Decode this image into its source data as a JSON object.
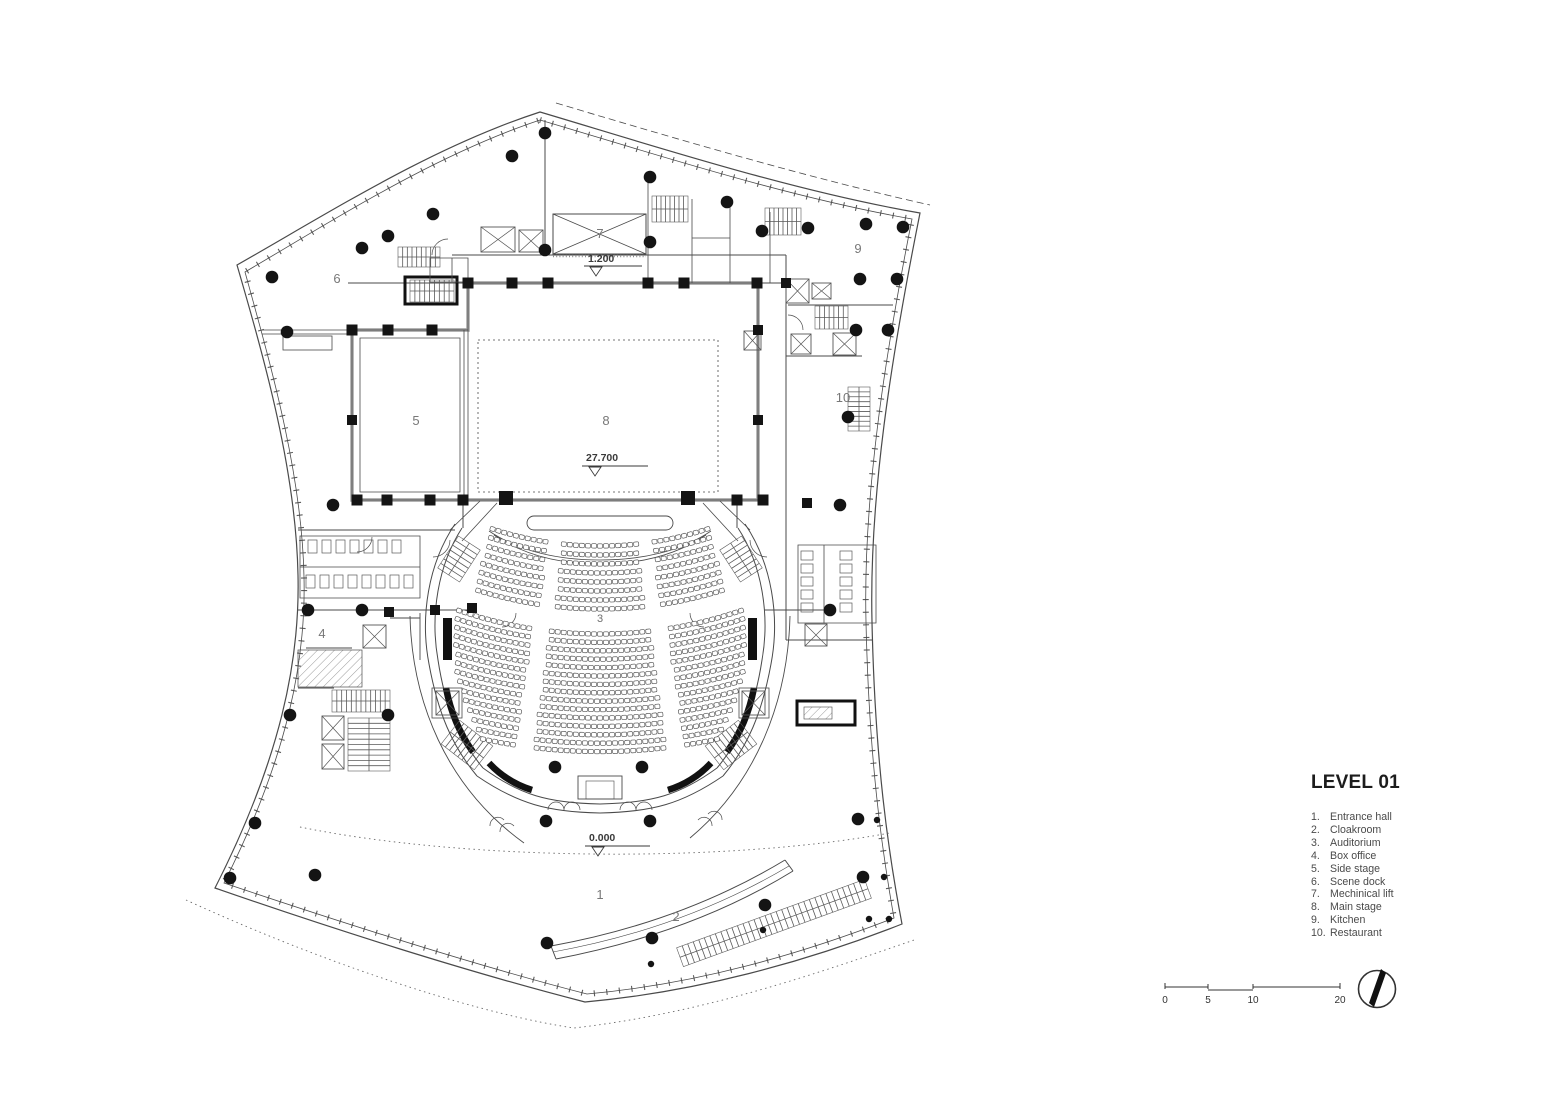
{
  "title": "LEVEL 01",
  "legend": {
    "items": [
      {
        "num": "1.",
        "name": "Entrance hall"
      },
      {
        "num": "2.",
        "name": "Cloakroom"
      },
      {
        "num": "3.",
        "name": "Auditorium"
      },
      {
        "num": "4.",
        "name": "Box office"
      },
      {
        "num": "5.",
        "name": "Side stage"
      },
      {
        "num": "6.",
        "name": "Scene dock"
      },
      {
        "num": "7.",
        "name": "Mechinical lift"
      },
      {
        "num": "8.",
        "name": "Main stage"
      },
      {
        "num": "9.",
        "name": "Kitchen"
      },
      {
        "num": "10.",
        "name": "Restaurant"
      }
    ]
  },
  "plan_labels": {
    "room1": "1",
    "room2": "2",
    "room3": "3",
    "room4": "4",
    "room5": "5",
    "room6": "6",
    "room7": "7",
    "room8": "8",
    "room9": "9",
    "room10": "10"
  },
  "elevations": {
    "stage_corridor": "1.200",
    "main_stage": "27.700",
    "entrance": "0.000"
  },
  "scale_bar": {
    "ticks": [
      "0",
      "5",
      "10",
      "20"
    ]
  },
  "colors": {
    "line": "#4a4a4a",
    "wall_gray": "#9c9c9c",
    "black": "#141414",
    "label": "#787878"
  },
  "seating": {
    "cx": 600,
    "cy": 198,
    "seat_w": 5,
    "seat_h": 4.4,
    "gap": 1.05,
    "blocks": [
      {
        "r0": 348,
        "rows": 8,
        "dr": 9,
        "sections": [
          [
            -20,
            -8.2
          ],
          [
            -6.6,
            6.6
          ],
          [
            8.2,
            20
          ]
        ],
        "hw": [
          [
            546,
            112
          ],
          [
            609,
            126
          ]
        ]
      },
      {
        "r0": 436,
        "rows": 15,
        "dr": 8.4,
        "sections": [
          [
            -19.6,
            -8.6
          ],
          [
            -7,
            7
          ],
          [
            8.6,
            19.6
          ]
        ],
        "hw": [
          [
            634,
            148
          ],
          [
            700,
            146
          ],
          [
            752,
            121
          ]
        ]
      }
    ]
  },
  "plan_geometry": {
    "dots": [
      [
        272,
        277
      ],
      [
        287,
        332
      ],
      [
        362,
        248
      ],
      [
        388,
        236
      ],
      [
        433,
        214
      ],
      [
        512,
        156
      ],
      [
        545,
        133
      ],
      [
        650,
        177
      ],
      [
        650,
        242
      ],
      [
        545,
        250
      ],
      [
        727,
        202
      ],
      [
        762,
        231
      ],
      [
        808,
        228
      ],
      [
        866,
        224
      ],
      [
        903,
        227
      ],
      [
        860,
        279
      ],
      [
        897,
        279
      ],
      [
        856,
        330
      ],
      [
        888,
        330
      ],
      [
        848,
        417
      ],
      [
        840,
        505
      ],
      [
        830,
        610
      ],
      [
        333,
        505
      ],
      [
        308,
        610
      ],
      [
        362,
        610
      ],
      [
        290,
        715
      ],
      [
        388,
        715
      ],
      [
        255,
        823
      ],
      [
        230,
        878
      ],
      [
        315,
        875
      ],
      [
        546,
        821
      ],
      [
        650,
        821
      ],
      [
        547,
        943
      ],
      [
        652,
        938
      ],
      [
        765,
        905
      ],
      [
        858,
        819
      ],
      [
        863,
        877
      ],
      [
        555,
        767
      ],
      [
        642,
        767
      ]
    ],
    "small_dots": [
      [
        877,
        820
      ],
      [
        884,
        877
      ],
      [
        869,
        919
      ],
      [
        889,
        919
      ],
      [
        651,
        964
      ],
      [
        763,
        930
      ]
    ],
    "squares": [
      [
        468,
        283,
        11
      ],
      [
        512,
        283,
        11
      ],
      [
        548,
        283,
        11
      ],
      [
        648,
        283,
        11
      ],
      [
        684,
        283,
        11
      ],
      [
        757,
        283,
        11
      ],
      [
        352,
        330,
        11
      ],
      [
        388,
        330,
        11
      ],
      [
        432,
        330,
        11
      ],
      [
        352,
        420,
        10
      ],
      [
        758,
        330,
        10
      ],
      [
        758,
        420,
        10
      ],
      [
        357,
        500,
        11
      ],
      [
        387,
        500,
        11
      ],
      [
        430,
        500,
        11
      ],
      [
        463,
        500,
        11
      ],
      [
        737,
        500,
        11
      ],
      [
        763,
        500,
        11
      ],
      [
        506,
        498,
        14
      ],
      [
        688,
        498,
        14
      ],
      [
        389,
        612,
        10
      ],
      [
        435,
        610,
        10
      ],
      [
        472,
        608,
        10
      ],
      [
        807,
        503,
        10
      ],
      [
        786,
        283,
        10
      ]
    ],
    "elevators": [
      [
        519,
        230,
        24,
        22
      ],
      [
        481,
        227,
        34,
        25
      ],
      [
        786,
        279,
        23,
        24
      ],
      [
        812,
        283,
        19,
        16
      ],
      [
        791,
        334,
        20,
        20
      ],
      [
        833,
        333,
        23,
        22
      ],
      [
        744,
        331,
        17,
        19
      ],
      [
        363,
        625,
        23,
        23
      ],
      [
        322,
        716,
        22,
        24
      ],
      [
        322,
        744,
        22,
        25
      ],
      [
        436,
        691,
        23,
        24
      ],
      [
        742,
        691,
        23,
        24
      ],
      [
        805,
        624,
        22,
        22
      ]
    ],
    "stairs": [
      [
        652,
        196,
        36,
        26,
        8,
        "v",
        0
      ],
      [
        765,
        208,
        36,
        27,
        8,
        "v",
        0
      ],
      [
        815,
        306,
        33,
        23,
        7,
        "v",
        0
      ],
      [
        848,
        387,
        22,
        44,
        9,
        "h",
        0
      ],
      [
        398,
        247,
        42,
        20,
        9,
        "v",
        0
      ],
      [
        410,
        280,
        44,
        22,
        9,
        "v",
        0
      ],
      [
        332,
        690,
        58,
        22,
        12,
        "v",
        0
      ],
      [
        348,
        718,
        42,
        53,
        10,
        "h",
        0
      ],
      [
        440,
        546,
        38,
        26,
        7,
        "v",
        -57
      ],
      [
        722,
        546,
        38,
        26,
        7,
        "v",
        57
      ],
      [
        446,
        730,
        42,
        30,
        8,
        "v",
        38
      ],
      [
        710,
        730,
        42,
        30,
        8,
        "v",
        -38
      ],
      [
        674,
        913,
        200,
        20,
        34,
        "v",
        -20
      ]
    ],
    "stalls": [
      {
        "x": 308,
        "y": 540,
        "dx": 14,
        "dy": 0,
        "n": 7,
        "w": 9,
        "h": 13
      },
      {
        "x": 306,
        "y": 575,
        "dx": 14,
        "dy": 0,
        "n": 8,
        "w": 9,
        "h": 13
      },
      {
        "x": 801,
        "y": 551,
        "dx": 0,
        "dy": 13,
        "n": 5,
        "w": 12,
        "h": 9
      },
      {
        "x": 840,
        "y": 551,
        "dx": 0,
        "dy": 13,
        "n": 5,
        "w": 12,
        "h": 9
      }
    ]
  }
}
